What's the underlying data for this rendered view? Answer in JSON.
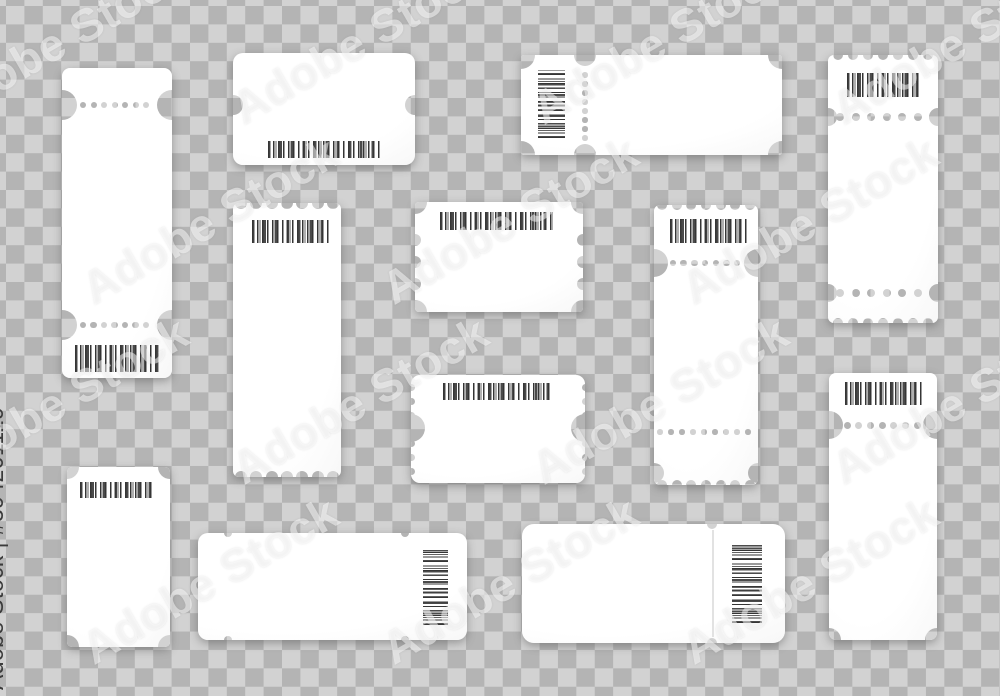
{
  "watermark": {
    "label": "Adobe Stock",
    "id_label": "Adobe Stock | #394201119",
    "text_color": "#3b3b3b",
    "overlay_color": "rgba(255,255,255,0.5)",
    "instances": [
      {
        "x": 60,
        "y": 40
      },
      {
        "x": 360,
        "y": 40
      },
      {
        "x": 660,
        "y": 40
      },
      {
        "x": 960,
        "y": 40
      },
      {
        "x": 210,
        "y": 220
      },
      {
        "x": 510,
        "y": 220
      },
      {
        "x": 810,
        "y": 220
      },
      {
        "x": 60,
        "y": 400
      },
      {
        "x": 360,
        "y": 400
      },
      {
        "x": 660,
        "y": 400
      },
      {
        "x": 960,
        "y": 400
      },
      {
        "x": 210,
        "y": 580
      },
      {
        "x": 510,
        "y": 580
      },
      {
        "x": 810,
        "y": 580
      }
    ]
  },
  "background": {
    "checker_dark": "#b4b4b4",
    "checker_light": "#d2d2d2",
    "square_px": 18.4
  },
  "ticket_color": "#ffffff",
  "barcode_color": "#3a3a3a",
  "tickets": [
    {
      "id": "tall-left",
      "x": 62,
      "y": 68,
      "w": 110,
      "h": 310,
      "r": 8,
      "features": [
        {
          "t": "stad",
          "cx": 0,
          "cy": 37,
          "w": 30,
          "h": 30
        },
        {
          "t": "stad",
          "cx": 110,
          "cy": 37,
          "w": 30,
          "h": 30
        },
        {
          "t": "dots",
          "x": 21,
          "y": 37,
          "n": 7,
          "gap": 10.5,
          "d": 6
        },
        {
          "t": "stad",
          "cx": 0,
          "cy": 257,
          "w": 30,
          "h": 30
        },
        {
          "t": "stad",
          "cx": 110,
          "cy": 257,
          "w": 30,
          "h": 30
        },
        {
          "t": "dots",
          "x": 21,
          "y": 257,
          "n": 7,
          "gap": 10.5,
          "d": 6.5
        },
        {
          "t": "bar",
          "x": 13,
          "y": 277,
          "w": 85,
          "h": 27,
          "o": "h"
        }
      ]
    },
    {
      "id": "rounded-top",
      "x": 233,
      "y": 53,
      "w": 182,
      "h": 112,
      "r": 10,
      "features": [
        {
          "t": "hole",
          "cx": 0,
          "cy": 52,
          "r": 10
        },
        {
          "t": "hole",
          "cx": 182,
          "cy": 52,
          "r": 10
        },
        {
          "t": "bar",
          "x": 35,
          "y": 88,
          "w": 112,
          "h": 17,
          "o": "h"
        }
      ]
    },
    {
      "id": "wide-top",
      "x": 521,
      "y": 55,
      "w": 261,
      "h": 100,
      "r": 3,
      "features": [
        {
          "t": "hole",
          "cx": 0,
          "cy": 0,
          "r": 14
        },
        {
          "t": "hole",
          "cx": 261,
          "cy": 0,
          "r": 14
        },
        {
          "t": "hole",
          "cx": 0,
          "cy": 100,
          "r": 14
        },
        {
          "t": "hole",
          "cx": 261,
          "cy": 100,
          "r": 14
        },
        {
          "t": "hole",
          "cx": 64,
          "cy": 0,
          "r": 11
        },
        {
          "t": "hole",
          "cx": 64,
          "cy": 100,
          "r": 11
        },
        {
          "t": "dots",
          "x": 64,
          "y": 20,
          "n": 8,
          "gap": 9,
          "d": 5.5,
          "o": "v"
        },
        {
          "t": "bar",
          "x": 17,
          "y": 15,
          "w": 27,
          "h": 68,
          "o": "v"
        }
      ]
    },
    {
      "id": "tall-right-top",
      "x": 828,
      "y": 55,
      "w": 110,
      "h": 268,
      "r": 6,
      "features": [
        {
          "t": "scal",
          "edge": "top",
          "from": 10,
          "to": 100,
          "n": 7,
          "r": 5
        },
        {
          "t": "scal",
          "edge": "bottom",
          "from": 10,
          "to": 100,
          "n": 7,
          "r": 5
        },
        {
          "t": "hole",
          "cx": 0,
          "cy": 62,
          "r": 9
        },
        {
          "t": "hole",
          "cx": 110,
          "cy": 62,
          "r": 9
        },
        {
          "t": "dots",
          "x": 12,
          "y": 62,
          "n": 7,
          "gap": 15.5,
          "d": 8
        },
        {
          "t": "hole",
          "cx": 0,
          "cy": 238,
          "r": 9
        },
        {
          "t": "hole",
          "cx": 110,
          "cy": 238,
          "r": 9
        },
        {
          "t": "dots",
          "x": 12,
          "y": 238,
          "n": 7,
          "gap": 15.5,
          "d": 8
        },
        {
          "t": "bar",
          "x": 19,
          "y": 18,
          "w": 73,
          "h": 24,
          "o": "h"
        }
      ]
    },
    {
      "id": "tall-mid-left",
      "x": 233,
      "y": 203,
      "w": 108,
      "h": 274,
      "r": 6,
      "features": [
        {
          "t": "scal",
          "edge": "top",
          "from": 8,
          "to": 100,
          "n": 7,
          "r": 6
        },
        {
          "t": "scal",
          "edge": "bottom",
          "from": 8,
          "to": 100,
          "n": 7,
          "r": 6
        },
        {
          "t": "bar",
          "x": 19,
          "y": 17,
          "w": 78,
          "h": 23,
          "o": "h"
        }
      ]
    },
    {
      "id": "small-center",
      "x": 415,
      "y": 202,
      "w": 168,
      "h": 110,
      "r": 4,
      "features": [
        {
          "t": "hole",
          "cx": 0,
          "cy": 0,
          "r": 12
        },
        {
          "t": "hole",
          "cx": 168,
          "cy": 0,
          "r": 12
        },
        {
          "t": "hole",
          "cx": 0,
          "cy": 110,
          "r": 12
        },
        {
          "t": "hole",
          "cx": 168,
          "cy": 110,
          "r": 12
        },
        {
          "t": "scal",
          "edge": "left",
          "from": 38,
          "to": 82,
          "n": 3,
          "r": 6
        },
        {
          "t": "scal",
          "edge": "right",
          "from": 38,
          "to": 82,
          "n": 3,
          "r": 6
        },
        {
          "t": "bar",
          "x": 25,
          "y": 10,
          "w": 113,
          "h": 18,
          "o": "h"
        }
      ]
    },
    {
      "id": "small-center-2",
      "x": 411,
      "y": 375,
      "w": 174,
      "h": 108,
      "r": 9,
      "features": [
        {
          "t": "scal",
          "edge": "left",
          "from": 12,
          "to": 96,
          "n": 7,
          "r": 3.5
        },
        {
          "t": "scal",
          "edge": "right",
          "from": 12,
          "to": 96,
          "n": 7,
          "r": 3.5
        },
        {
          "t": "hole",
          "cx": 0,
          "cy": 53,
          "r": 14
        },
        {
          "t": "hole",
          "cx": 174,
          "cy": 53,
          "r": 14
        },
        {
          "t": "bar",
          "x": 32,
          "y": 8,
          "w": 110,
          "h": 17,
          "o": "h"
        }
      ]
    },
    {
      "id": "tall-mid-right",
      "x": 654,
      "y": 205,
      "w": 104,
      "h": 280,
      "r": 6,
      "features": [
        {
          "t": "scal",
          "edge": "top",
          "from": 8,
          "to": 96,
          "n": 7,
          "r": 5
        },
        {
          "t": "scal",
          "edge": "bottom",
          "from": 8,
          "to": 96,
          "n": 7,
          "r": 5
        },
        {
          "t": "stad",
          "cx": 0,
          "cy": 58,
          "w": 28,
          "h": 28
        },
        {
          "t": "stad",
          "cx": 104,
          "cy": 58,
          "w": 28,
          "h": 28
        },
        {
          "t": "dots",
          "x": 19,
          "y": 58,
          "n": 7,
          "gap": 10.7,
          "d": 6.5
        },
        {
          "t": "dots",
          "x": 6,
          "y": 227,
          "n": 9,
          "gap": 11,
          "d": 5.5
        },
        {
          "t": "hole",
          "cx": 0,
          "cy": 268,
          "r": 10
        },
        {
          "t": "hole",
          "cx": 104,
          "cy": 268,
          "r": 10
        },
        {
          "t": "bar",
          "x": 16,
          "y": 14,
          "w": 77,
          "h": 24,
          "o": "h"
        }
      ]
    },
    {
      "id": "tall-right-mid",
      "x": 829,
      "y": 373,
      "w": 108,
      "h": 267,
      "r": 7,
      "features": [
        {
          "t": "stad",
          "cx": 0,
          "cy": 52,
          "w": 28,
          "h": 28
        },
        {
          "t": "stad",
          "cx": 108,
          "cy": 52,
          "w": 28,
          "h": 28
        },
        {
          "t": "dots",
          "x": 18,
          "y": 52,
          "n": 7,
          "gap": 11.7,
          "d": 7
        },
        {
          "t": "hole",
          "cx": 0,
          "cy": 267,
          "r": 12
        },
        {
          "t": "hole",
          "cx": 108,
          "cy": 267,
          "r": 12
        },
        {
          "t": "bar",
          "x": 16,
          "y": 9,
          "w": 77,
          "h": 23,
          "o": "h"
        }
      ]
    },
    {
      "id": "small-bottom-left",
      "x": 67,
      "y": 467,
      "w": 103,
      "h": 180,
      "r": 5,
      "features": [
        {
          "t": "hole",
          "cx": 0,
          "cy": 0,
          "r": 12
        },
        {
          "t": "hole",
          "cx": 103,
          "cy": 0,
          "r": 12
        },
        {
          "t": "hole",
          "cx": 0,
          "cy": 180,
          "r": 12
        },
        {
          "t": "hole",
          "cx": 103,
          "cy": 180,
          "r": 12
        },
        {
          "t": "bar",
          "x": 13,
          "y": 15,
          "w": 75,
          "h": 16,
          "o": "h"
        }
      ]
    },
    {
      "id": "wide-bottom-left",
      "x": 198,
      "y": 533,
      "w": 269,
      "h": 107,
      "r": 10,
      "features": [
        {
          "t": "hole",
          "cx": 30,
          "cy": 0,
          "r": 4
        },
        {
          "t": "hole",
          "cx": 30,
          "cy": 107,
          "r": 4
        },
        {
          "t": "hole",
          "cx": 207,
          "cy": 0,
          "r": 4
        },
        {
          "t": "hole",
          "cx": 207,
          "cy": 107,
          "r": 4
        },
        {
          "t": "bar",
          "x": 225,
          "y": 17,
          "w": 25,
          "h": 75,
          "o": "v"
        }
      ]
    },
    {
      "id": "wide-bottom-right",
      "x": 522,
      "y": 524,
      "w": 263,
      "h": 119,
      "r": 12,
      "features": [
        {
          "t": "hole",
          "cx": 190,
          "cy": 0,
          "r": 5
        },
        {
          "t": "hole",
          "cx": 190,
          "cy": 119,
          "r": 5
        },
        {
          "t": "seam",
          "x": 190,
          "y1": 6,
          "y2": 113
        },
        {
          "t": "bar",
          "x": 210,
          "y": 18,
          "w": 30,
          "h": 81,
          "o": "v"
        }
      ]
    }
  ]
}
